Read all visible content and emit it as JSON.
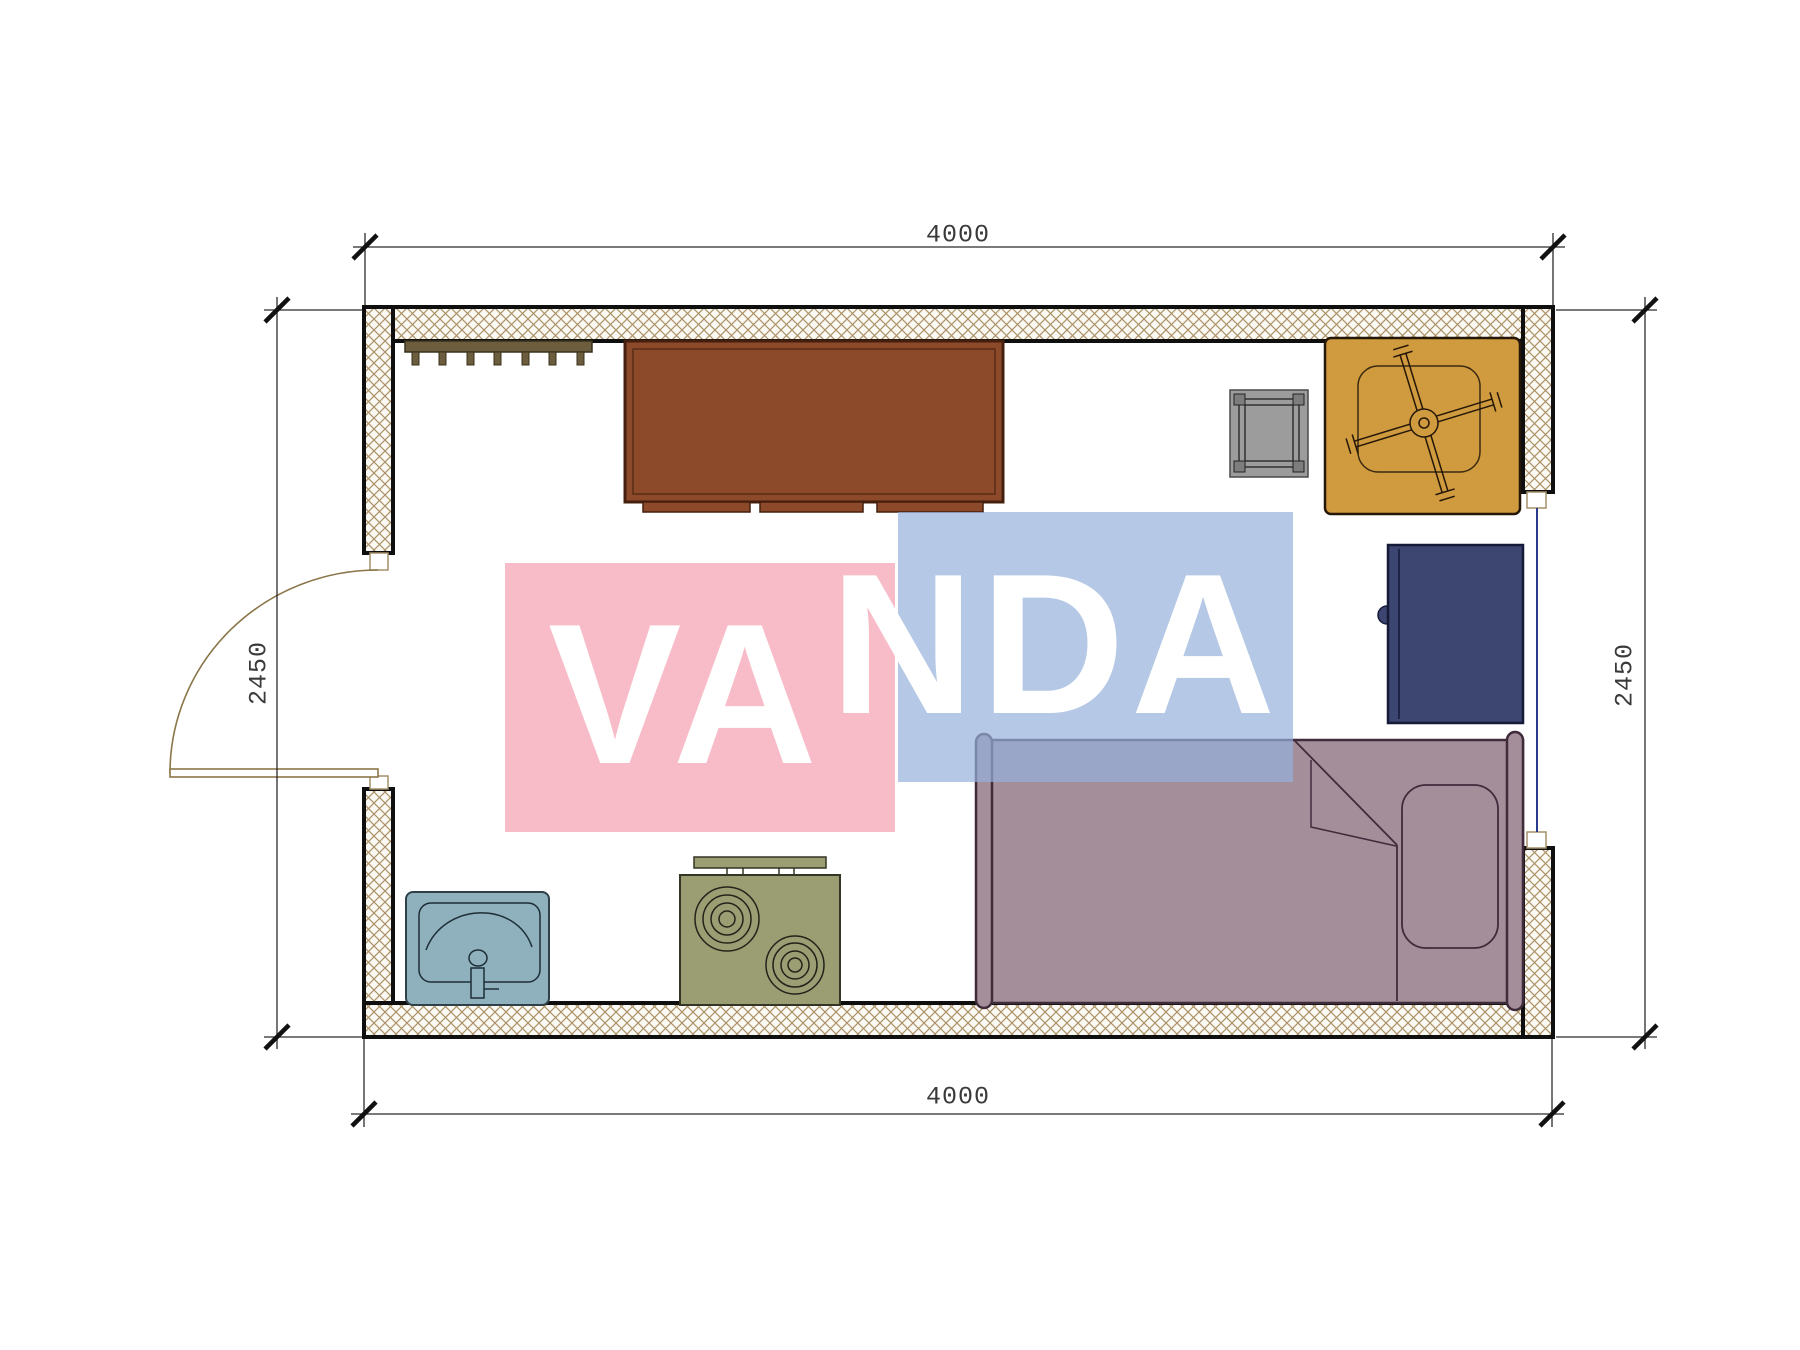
{
  "title": "Room floor plan 4000 x 2450",
  "dimensions": {
    "top": "4000",
    "bottom": "4000",
    "left": "2450",
    "right": "2450"
  },
  "watermark": {
    "full": "VANDA",
    "part1": "VA",
    "part2": "NDA",
    "pink_color": "#f8bfc8",
    "blue_color": "#b8c9e7",
    "text_color": "#ffffff"
  },
  "colors": {
    "wall_hatch": "#ab9166",
    "wall_outline": "#0f0f0f",
    "dimension_line": "#2b2b2b",
    "desk": "#8c4a2a",
    "coat_rack": "#6b5d3d",
    "stool": "#9c9c9c",
    "armchair": "#d09a3e",
    "wardrobe": "#3d4571",
    "bed": "#a38e9a",
    "sink": "#8fb1bd",
    "stove": "#9b9d73",
    "window_glass": "#2a3b8c",
    "door": "#8a7648"
  },
  "furniture_icons": [
    "coat-rack-icon",
    "desk-icon",
    "stool-icon",
    "armchair-icon",
    "wardrobe-icon",
    "bed-icon",
    "sink-icon",
    "stove-icon",
    "door-icon",
    "window-icon"
  ]
}
